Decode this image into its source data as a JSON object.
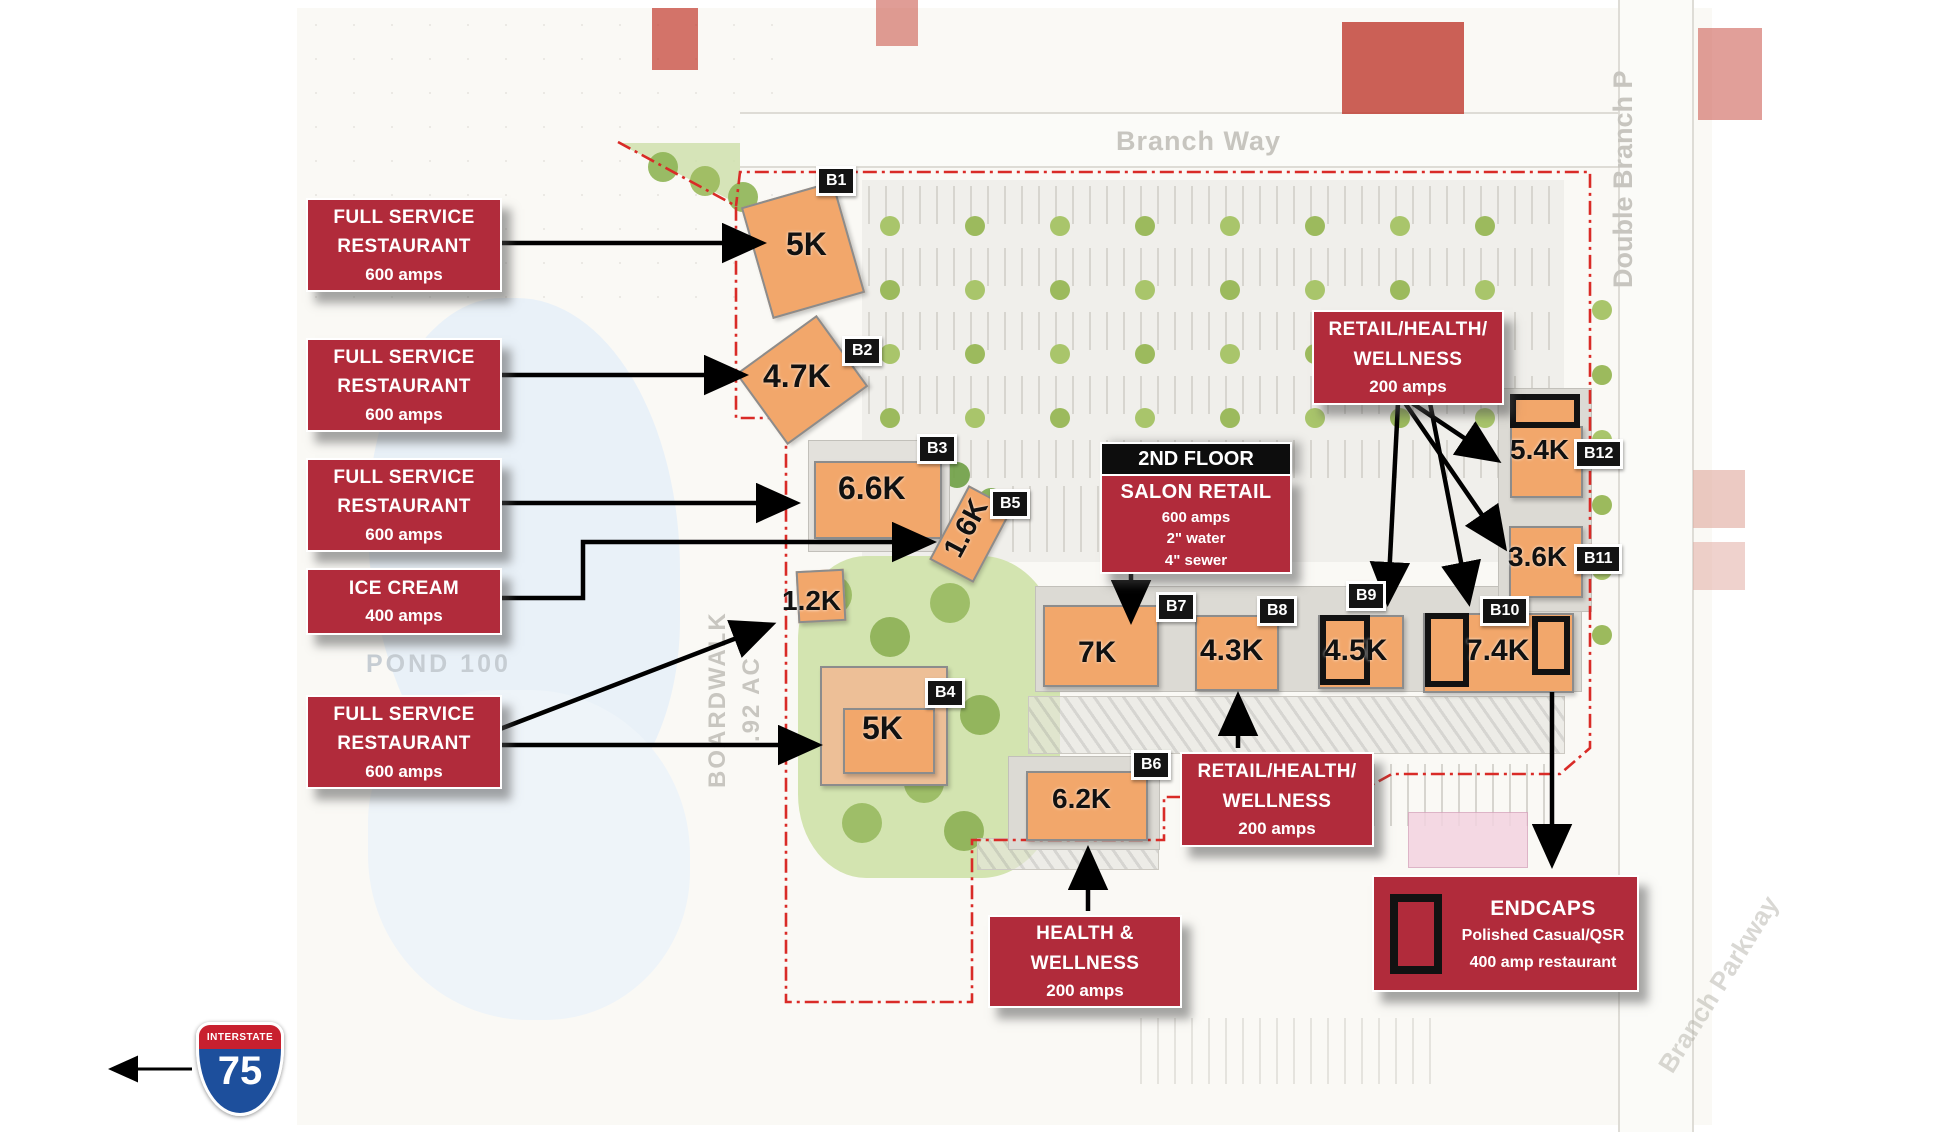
{
  "streets": {
    "branch_way": "Branch Way",
    "double_branch": "Double Branch P",
    "branch_parkway": "Branch Parkway"
  },
  "site_labels": {
    "pond": "POND 100",
    "boardwalk": "BOARDWALK",
    "acreage": ".92 AC"
  },
  "callouts": [
    {
      "lines": [
        "FULL SERVICE",
        "RESTAURANT"
      ],
      "sub": "600 amps"
    },
    {
      "lines": [
        "FULL SERVICE",
        "RESTAURANT"
      ],
      "sub": "600 amps"
    },
    {
      "lines": [
        "FULL SERVICE",
        "RESTAURANT"
      ],
      "sub": "600 amps"
    },
    {
      "lines": [
        "ICE CREAM"
      ],
      "sub": "400 amps"
    },
    {
      "lines": [
        "FULL SERVICE",
        "RESTAURANT"
      ],
      "sub": "600 amps"
    }
  ],
  "salon": {
    "header": "2ND FLOOR",
    "title": "SALON RETAIL",
    "subs": [
      "600 amps",
      "2\" water",
      "4\" sewer"
    ]
  },
  "retail_top": {
    "lines": [
      "RETAIL/HEALTH/",
      "WELLNESS"
    ],
    "sub": "200 amps"
  },
  "retail_bottom": {
    "lines": [
      "RETAIL/HEALTH/",
      "WELLNESS"
    ],
    "sub": "200 amps"
  },
  "health_wellness": {
    "lines": [
      "HEALTH &",
      "WELLNESS"
    ],
    "sub": "200 amps"
  },
  "endcaps": {
    "title": "ENDCAPS",
    "line1": "Polished Casual/QSR",
    "line2": "400 amp restaurant"
  },
  "buildings": [
    {
      "badge": "B1",
      "size": "5K"
    },
    {
      "badge": "B2",
      "size": "4.7K"
    },
    {
      "badge": "B3",
      "size": "6.6K"
    },
    {
      "badge": "B5",
      "size": "1.6K"
    },
    {
      "badge": "B4",
      "size": "5K"
    },
    {
      "badge": "B6",
      "size": "6.2K"
    },
    {
      "badge": "B7",
      "size": "7K"
    },
    {
      "badge": "B8",
      "size": "4.3K"
    },
    {
      "badge": "B9",
      "size": "4.5K"
    },
    {
      "badge": "B10",
      "size": "7.4K"
    },
    {
      "badge": "B11",
      "size": "3.6K"
    },
    {
      "badge": "B12",
      "size": "5.4K"
    },
    {
      "badge": "",
      "size": "1.2K"
    }
  ],
  "interstate": {
    "label": "INTERSTATE",
    "number": "75"
  },
  "colors": {
    "callout_red": "#b12b3b",
    "building_orange": "#f2a76b",
    "badge_black": "#141414",
    "boundary_red": "#d92b27",
    "shield_blue": "#1d4f9c",
    "shield_red": "#c8202f"
  }
}
